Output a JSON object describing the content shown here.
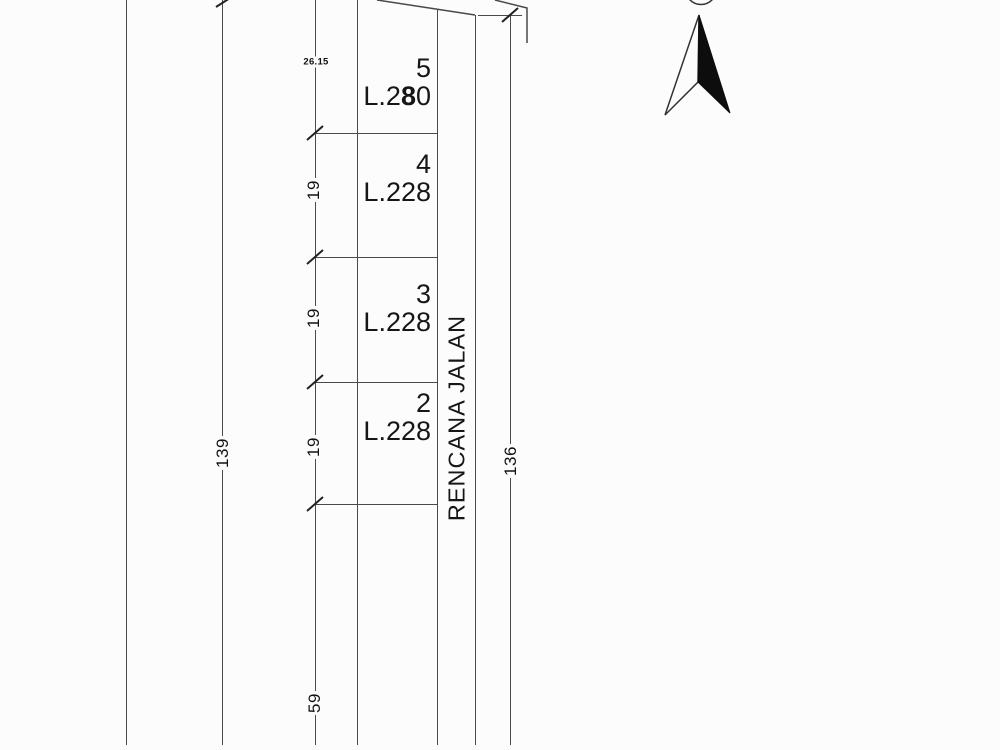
{
  "road": {
    "label": "RENCANA JALAN"
  },
  "plots": [
    {
      "number": "5",
      "area_pre": "L.2",
      "area_bold": "8",
      "area_post": "0"
    },
    {
      "number": "4",
      "area_pre": "L.228",
      "area_bold": "",
      "area_post": ""
    },
    {
      "number": "3",
      "area_pre": "L.228",
      "area_bold": "",
      "area_post": ""
    },
    {
      "number": "2",
      "area_pre": "L.228",
      "area_bold": "",
      "area_post": ""
    }
  ],
  "dimensions": {
    "left_total": "139",
    "right_total": "136",
    "top_segment": "26.15",
    "plot_depths": [
      "19",
      "19",
      "19"
    ],
    "bottom_segment": "59"
  },
  "icons": {
    "north_arrow": "north-arrow-icon"
  },
  "colors": {
    "line": "#4a4a4a",
    "text": "#161616",
    "background": "#fcfcfc",
    "north_fill": "#0d0d0d"
  }
}
